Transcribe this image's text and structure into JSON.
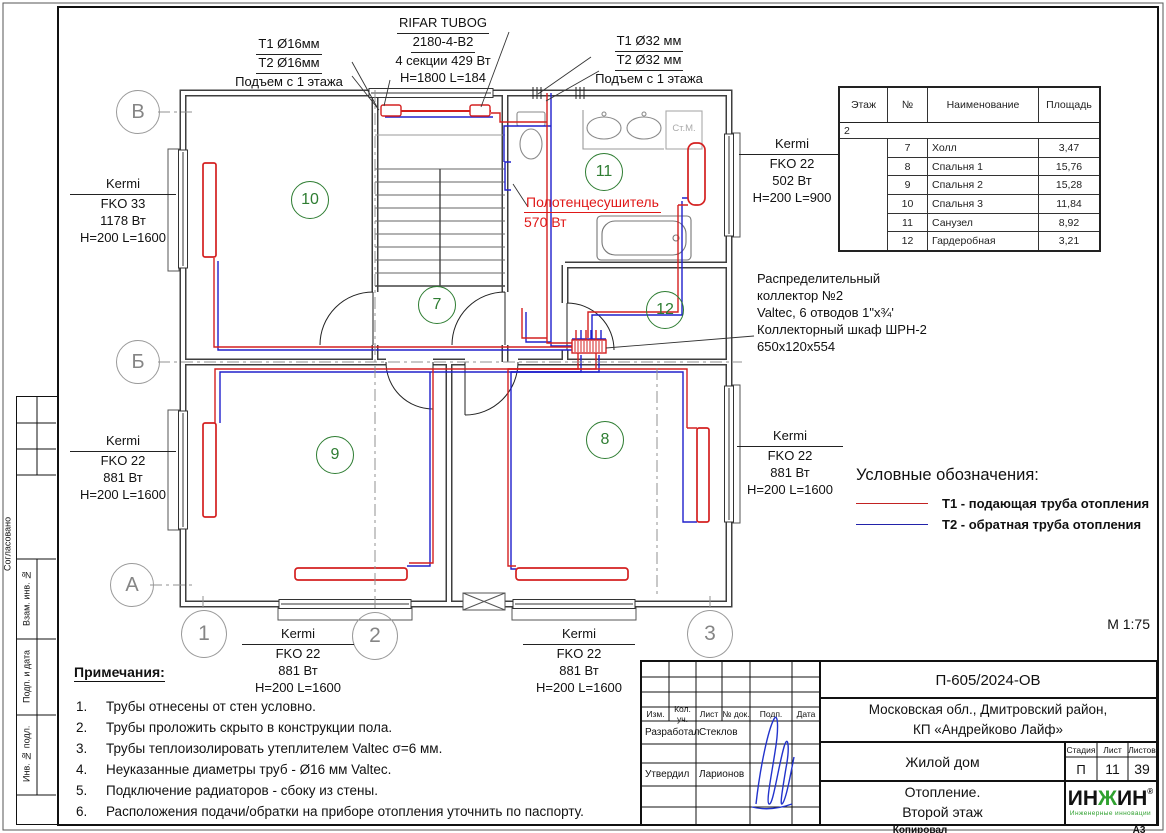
{
  "colors": {
    "pipe_supply": "#d42020",
    "pipe_return": "#2020cc",
    "room_number_green": "#2e7d32",
    "annotation_red": "#e01818",
    "logo_green": "#2fa12f"
  },
  "plan": {
    "axis_rows": [
      "В",
      "Б",
      "А"
    ],
    "axis_cols": [
      "1",
      "2",
      "3"
    ],
    "rooms": {
      "r7": "7",
      "r8": "8",
      "r9": "9",
      "r10": "10",
      "r11": "11",
      "r12": "12"
    },
    "stm": "Ст.М.",
    "scale": "М 1:75"
  },
  "callouts": {
    "riser16": {
      "l1": "Т1 Ø16мм",
      "l2": "Т2 Ø16мм",
      "l3": "Подъем с 1 этажа"
    },
    "riser32": {
      "l1": "Т1 Ø32 мм",
      "l2": "Т2 Ø32 мм",
      "l3": "Подъем с 1 этажа"
    },
    "rifar": {
      "l1": "RIFAR TUBOG",
      "l2": "2180-4-В2",
      "l3": "4 секции 429 Вт",
      "l4": "H=1800 L=184"
    },
    "k10": {
      "brand": "Kermi",
      "model": "FKO 33",
      "power": "1178 Вт",
      "size": "H=200 L=1600"
    },
    "k9l": {
      "brand": "Kermi",
      "model": "FKO 22",
      "power": "881 Вт",
      "size": "H=200 L=1600"
    },
    "k11": {
      "brand": "Kermi",
      "model": "FKO 22",
      "power": "502 Вт",
      "size": "H=200 L=900"
    },
    "k8r": {
      "brand": "Kermi",
      "model": "FKO 22",
      "power": "881 Вт",
      "size": "H=200 L=1600"
    },
    "k9b": {
      "brand": "Kermi",
      "model": "FKO 22",
      "power": "881 Вт",
      "size": "H=200 L=1600"
    },
    "k8b": {
      "brand": "Kermi",
      "model": "FKO 22",
      "power": "881 Вт",
      "size": "H=200 L=1600"
    },
    "towel": {
      "l1": "Полотенцесушитель",
      "l2": "570 Вт"
    },
    "collector": {
      "l1": "Распределительный",
      "l2": "коллектор №2",
      "l3": "Valtec, 6 отводов 1\"х¾'",
      "l4": "Коллекторный шкаф ШРН-2",
      "l5": "650х120х554"
    }
  },
  "room_table": {
    "headers": [
      "Этаж",
      "№",
      "Наименование",
      "Площадь"
    ],
    "floor": "2",
    "rows": [
      {
        "num": "7",
        "name": "Холл",
        "area": "3,47"
      },
      {
        "num": "8",
        "name": "Спальня 1",
        "area": "15,76"
      },
      {
        "num": "9",
        "name": "Спальня 2",
        "area": "15,28"
      },
      {
        "num": "10",
        "name": "Спальня 3",
        "area": "11,84"
      },
      {
        "num": "11",
        "name": "Санузел",
        "area": "8,92"
      },
      {
        "num": "12",
        "name": "Гардеробная",
        "area": "3,21"
      }
    ]
  },
  "legend": {
    "title": "Условные обозначения:",
    "items": [
      {
        "label": "Т1 - подающая труба отопления",
        "color": "#c22222"
      },
      {
        "label": "Т2 - обратная труба отопления",
        "color": "#2222aa"
      }
    ]
  },
  "notes": {
    "title": "Примечания:",
    "nums": [
      "1.",
      "2.",
      "3.",
      "4.",
      "5.",
      "6."
    ],
    "items": [
      "Трубы отнесены от стен условно.",
      "Трубы проложить скрыто в конструкции пола.",
      "Трубы теплоизолировать утеплителем Valtec σ=6 мм.",
      "Неуказанные диаметры труб - Ø16 мм Valtec.",
      "Подключение радиаторов - сбоку из стены.",
      "Расположения подачи/обратки на приборе отопления уточнить по паспорту."
    ]
  },
  "title_block": {
    "doc": "П-605/2024-ОВ",
    "addr1": "Московская обл., Дмитровский район,",
    "addr2": "КП «Андрейково Лайф»",
    "cols": [
      "Изм.",
      "Кол. уч.",
      "Лист",
      "№ док.",
      "Подп.",
      "Дата"
    ],
    "dev_label": "Разработал",
    "dev_name": "Стеклов",
    "app_label": "Утвердил",
    "app_name": "Ларионов",
    "object": "Жилой дом",
    "stage_h": "Стадия",
    "sheet_h": "Лист",
    "sheets_h": "Листов",
    "stage": "П",
    "sheet": "11",
    "sheets": "39",
    "title1": "Отопление.",
    "title2": "Второй этаж",
    "logo_a": "ИН",
    "logo_b": "Ж",
    "logo_c": "ИН",
    "logo_r": "®",
    "logo_sub": "Инженерные инновации",
    "copied": "Копировал",
    "format": "А3"
  },
  "side_column": {
    "soglasovano": "Согласовано",
    "vzam": "Взам. инв. №",
    "podp": "Подп. и дата",
    "inv": "Инв. № подл."
  }
}
